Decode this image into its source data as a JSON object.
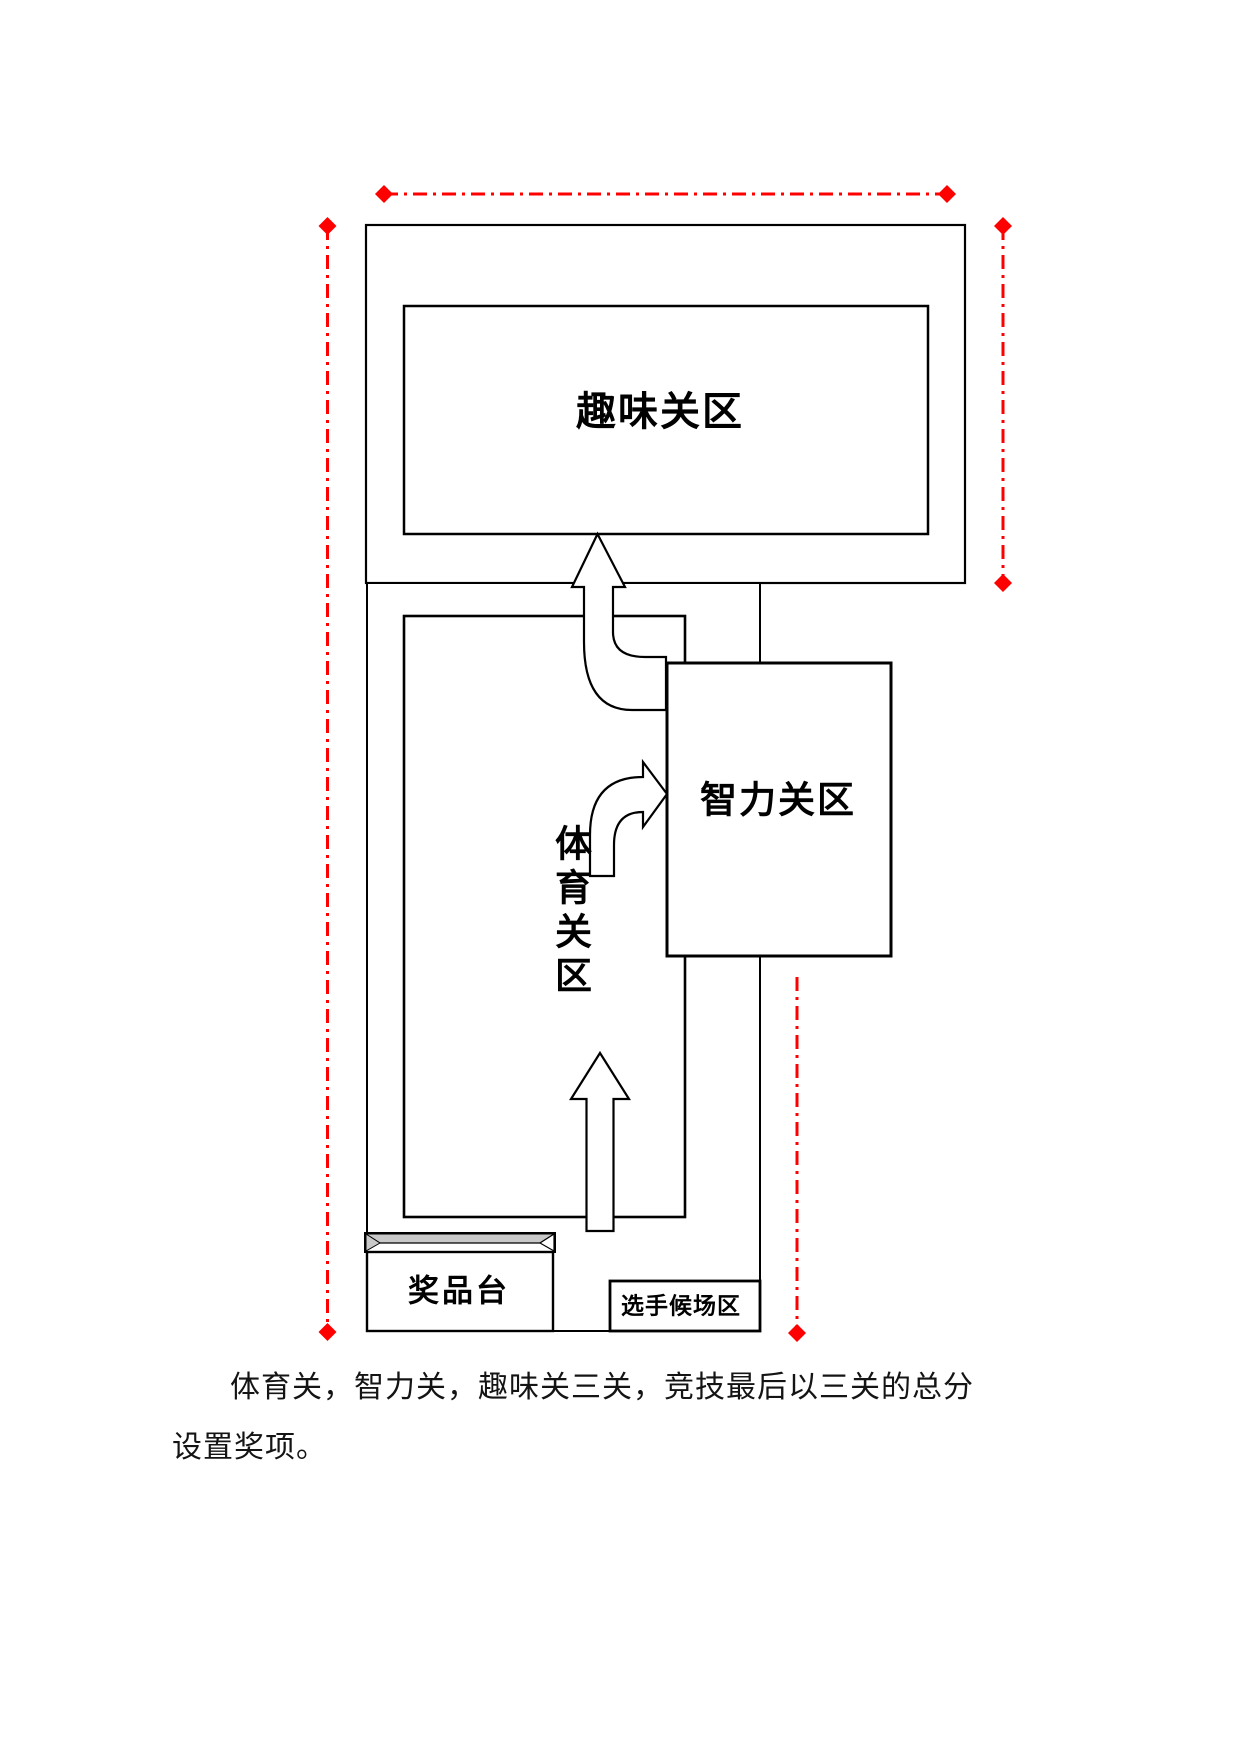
{
  "document": {
    "kind": "venue layout diagram",
    "background": "#ffffff"
  },
  "diagram": {
    "labels": {
      "fun_zone": "趣味关区",
      "intelligence_zone": "智力关区",
      "sports_zone": "体育关区",
      "prize_table": "奖品台",
      "waiting_area": "选手候场区"
    },
    "colors": {
      "outline": "#000000",
      "zone_fill": "#ffffff",
      "dimension_line": "#ff0000",
      "prize_top_gray": "#c9c9c9"
    },
    "arrows": {
      "count": 3,
      "style": "white block arrows with black outline",
      "flow": "corridor up into sports zone, bend right into intelligence zone, bend up into fun zone"
    },
    "dimension_lines": {
      "style": "red dash-dot with diamond endpoints",
      "positions": [
        "top horizontal",
        "left vertical",
        "upper right vertical",
        "lower right vertical"
      ]
    }
  },
  "paragraph": {
    "line1": "体育关，智力关，趣味关三关，竞技最后以三关的总分",
    "line2": "设置奖项。"
  }
}
